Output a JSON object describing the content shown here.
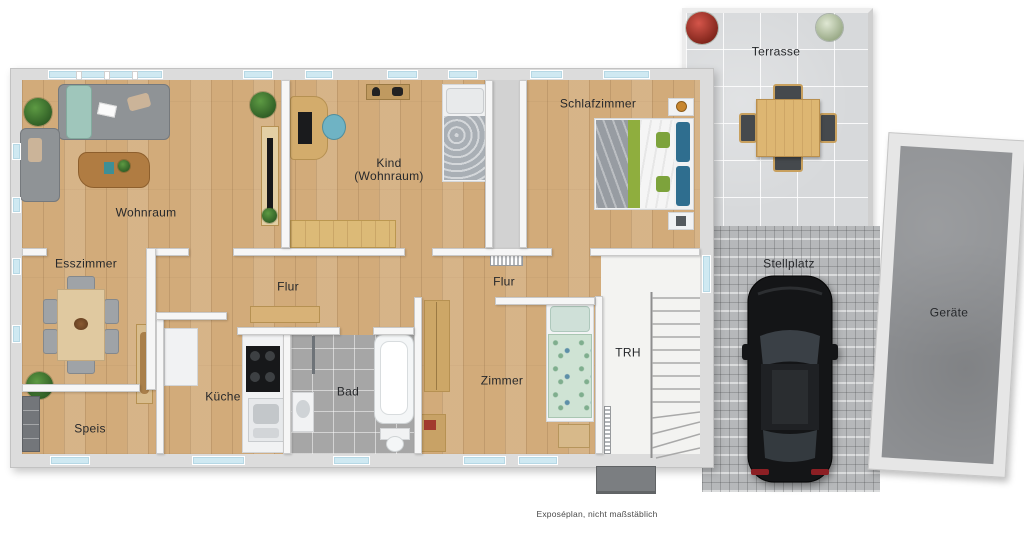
{
  "plan": {
    "footnote": "Exposéplan, nicht maßstäblich",
    "rooms": {
      "wohnraum": "Wohnraum",
      "esszimmer": "Esszimmer",
      "speis": "Speis",
      "kueche": "Küche",
      "flur_west": "Flur",
      "flur_ost": "Flur",
      "bad": "Bad",
      "kind_line1": "Kind",
      "kind_line2": "(Wohnraum)",
      "schlafzimmer": "Schlafzimmer",
      "zimmer": "Zimmer",
      "trh": "TRH",
      "terrasse": "Terrasse",
      "stellplatz": "Stellplatz",
      "geraete": "Geräte"
    },
    "colors": {
      "wood_floor": "#d2ab7a",
      "wall_outer": "#dcdcdc",
      "wall_inner": "#f6f6f6",
      "window_glass": "#cfe9f2",
      "bath_tile": "#a6a6a6",
      "terrace_tile": "#d7d9db",
      "paving": "#b6b8ba",
      "shed_concrete": "#8f9194",
      "car_body": "#17181a",
      "label_text": "#26282b"
    }
  }
}
